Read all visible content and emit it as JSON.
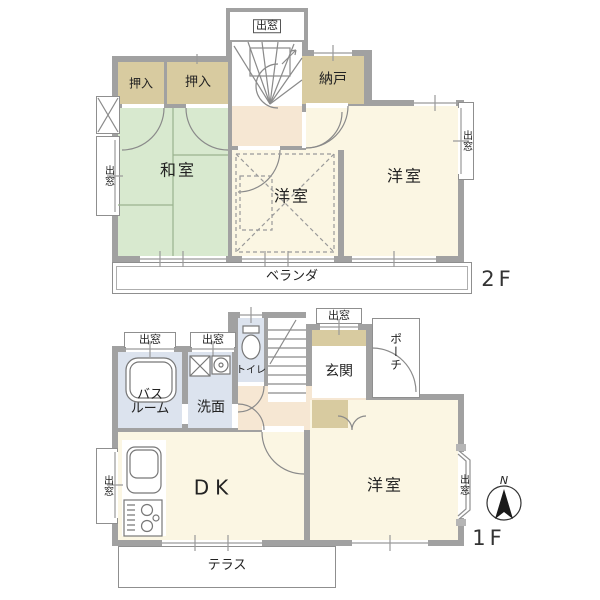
{
  "floor2": {
    "floor_label": "2F",
    "rooms": {
      "washitsu": "和室",
      "oshiire_left": "押入",
      "oshiire_right": "押入",
      "nando": "納戸",
      "yoshitsu_center": "洋室",
      "yoshitsu_right": "洋室",
      "veranda": "ベランダ"
    },
    "windows": {
      "top_bay": "出窓",
      "left_bay": "出窓",
      "right_bay": "出窓"
    }
  },
  "floor1": {
    "floor_label": "1F",
    "rooms": {
      "bathroom_line1": "バス",
      "bathroom_line2": "ルーム",
      "senmen": "洗面",
      "toilet": "トイレ",
      "genkan": "玄関",
      "porch": "ポーチ",
      "dk": "DK",
      "yoshitsu": "洋室",
      "terrace": "テラス"
    },
    "windows": {
      "bath_bay": "出窓",
      "senmen_bay": "出窓",
      "genkan_bay": "出窓",
      "left_bay": "出窓",
      "right_bay": "出窓"
    }
  },
  "compass": {
    "north_label": "N"
  },
  "colors": {
    "wall": "#a1a1a1",
    "tatami_room": "#d8e9cf",
    "western_room": "#fbf6e3",
    "hall": "#f6e7d3",
    "closet": "#d8cba0",
    "wet_area": "#dce3ee",
    "line": "#8a8a8a",
    "text": "#222222"
  }
}
